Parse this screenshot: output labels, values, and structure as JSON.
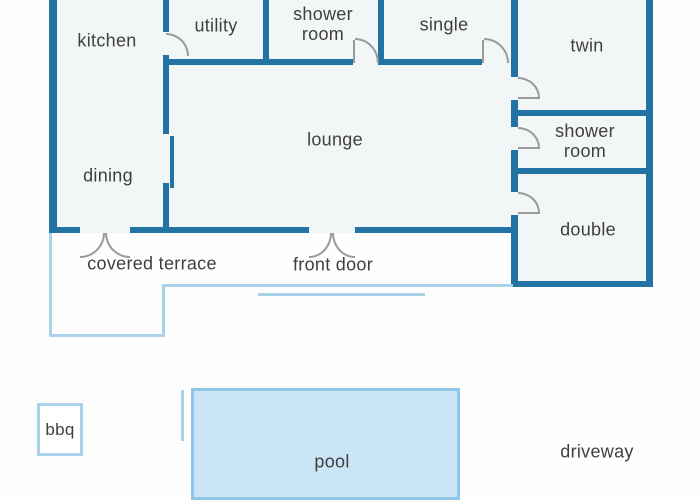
{
  "colors": {
    "wall": "#2272a4",
    "light": "#a8d3e8",
    "pool_fill": "#c9e5f6",
    "pool_border": "#8fc8e6",
    "text": "#3f3f3f"
  },
  "rooms": {
    "kitchen": {
      "label": "kitchen"
    },
    "utility": {
      "label": "utility"
    },
    "shower_room_top": {
      "label": "shower room"
    },
    "single": {
      "label": "single"
    },
    "twin": {
      "label": "twin"
    },
    "lounge": {
      "label": "lounge"
    },
    "dining": {
      "label": "dining"
    },
    "shower_room_right": {
      "label": "shower room"
    },
    "double": {
      "label": "double"
    }
  },
  "outdoor": {
    "covered_terrace": {
      "label": "covered terrace"
    },
    "front_door": {
      "label": "front door"
    },
    "bbq": {
      "label": "bbq"
    },
    "pool": {
      "label": "pool"
    },
    "driveway": {
      "label": "driveway"
    }
  }
}
